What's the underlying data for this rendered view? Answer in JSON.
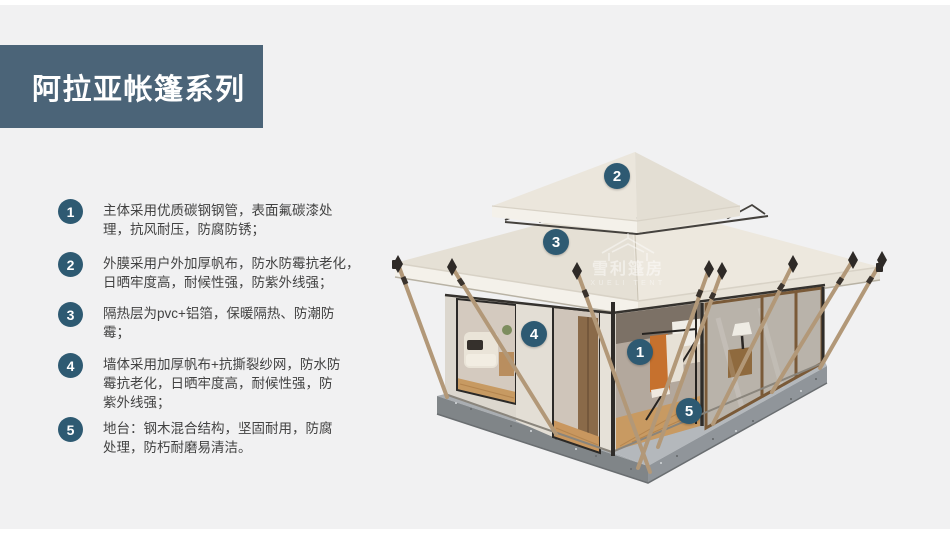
{
  "page": {
    "background": "#f1f1f2",
    "accent": "#2e5a72",
    "banner_color": "#4b6478",
    "text_color": "#424242"
  },
  "header": {
    "title": "阿拉亚帐篷系列"
  },
  "features": [
    {
      "num": "1",
      "lines": [
        "主体采用优质碳钢钢管，表面氟碳漆处",
        "理，抗风耐压，防腐防锈；"
      ]
    },
    {
      "num": "2",
      "lines": [
        "外膜采用户外加厚帆布，防水防霉抗老化，",
        "日晒牢度高，耐候性强，防紫外线强；"
      ]
    },
    {
      "num": "3",
      "lines": [
        "隔热层为pvc+铝箔，保暖隔热、防潮防",
        "霉；"
      ]
    },
    {
      "num": "4",
      "lines": [
        "墙体采用加厚帆布+抗撕裂纱网，防水防",
        "霉抗老化，日晒牢度高，耐候性强，防",
        "紫外线强；"
      ]
    },
    {
      "num": "5",
      "lines": [
        "地台：钢木混合结构，坚固耐用，防腐",
        "处理，防朽耐磨易清洁。"
      ]
    }
  ],
  "tent_markers": [
    {
      "label": "1"
    },
    {
      "label": "2"
    },
    {
      "label": "3"
    },
    {
      "label": "4"
    },
    {
      "label": "5"
    }
  ],
  "watermark": {
    "cn": "雪利篷房",
    "en": "XUELI TENT"
  },
  "tent_palette": {
    "roof": "#ece7dd",
    "wall": "#dcd7ce",
    "base_concrete": "#85898c",
    "wood_pole": "#b29878",
    "floor_wood": "#c89a62",
    "garment_orange": "#c6712e"
  }
}
